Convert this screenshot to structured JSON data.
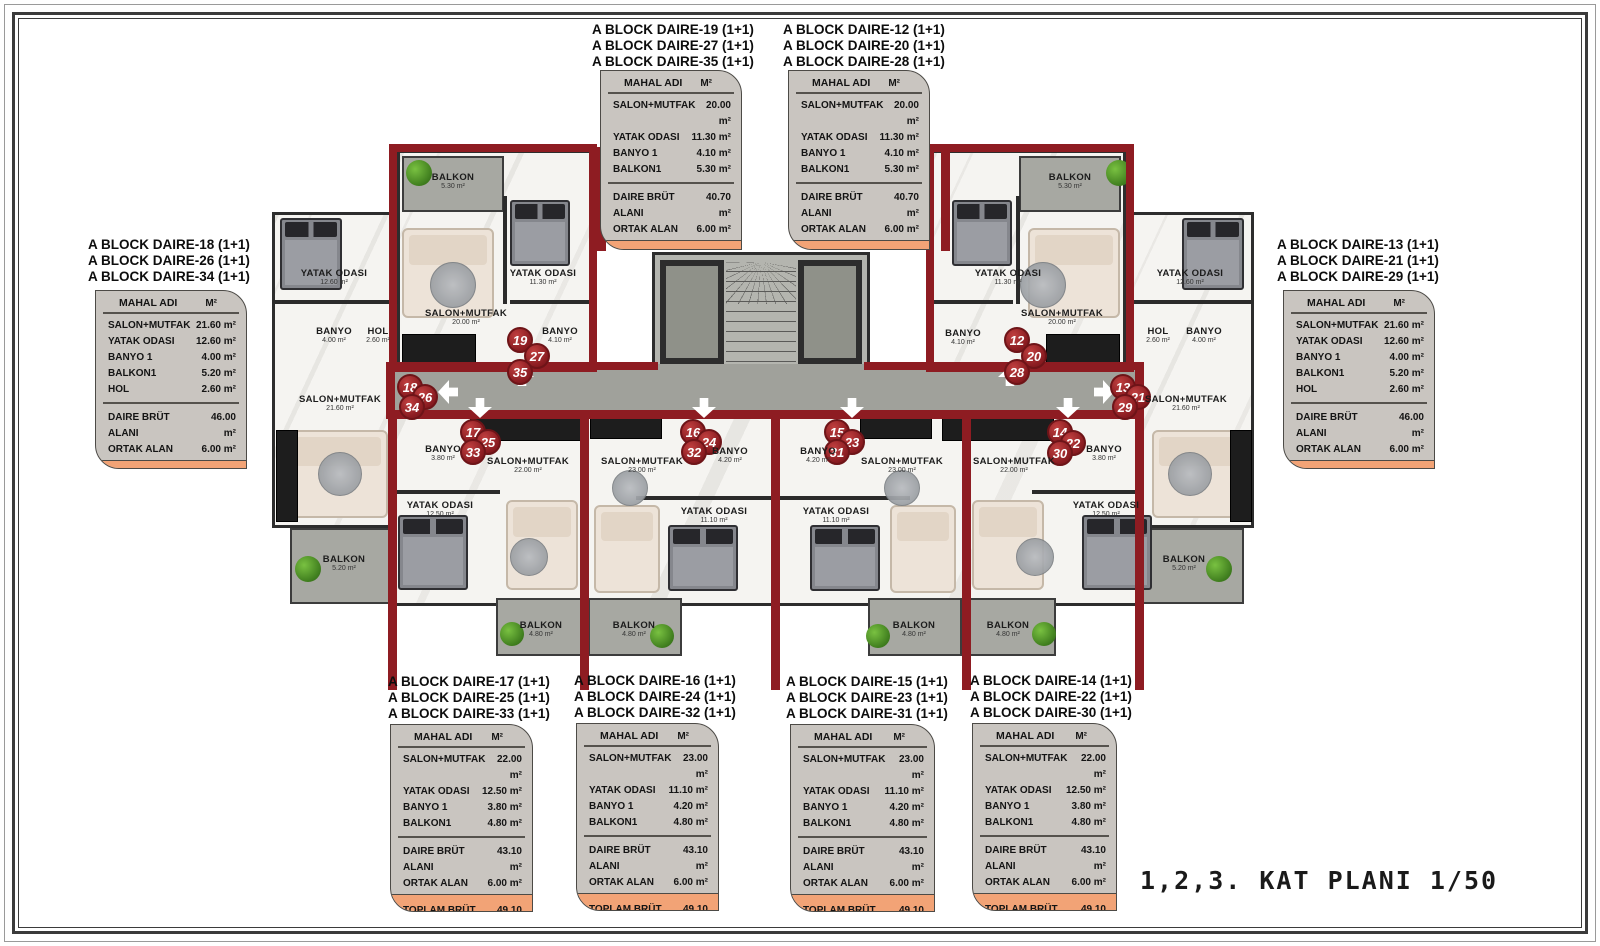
{
  "page": {
    "plan_title": "1,2,3. KAT PLANI 1/50"
  },
  "colors": {
    "unit_line_red": "#8e1c22",
    "badge_red": "#8c1d22",
    "card_gray": "#c9c5c0",
    "card_orange": "#f2a376",
    "wall_dark": "#2d2d2d"
  },
  "icons": {
    "entrance_arrow": "⇩ white outlined arrow",
    "plant": "green shrub circle"
  },
  "table_header": {
    "name_col": "MAHAL ADI",
    "unit_col": "M²"
  },
  "cards": [
    {
      "titles": [
        "A BLOCK DAIRE-18  (1+1)",
        "A BLOCK DAIRE-26  (1+1)",
        "A BLOCK DAIRE-34  (1+1)"
      ],
      "rows": [
        {
          "label": "SALON+MUTFAK",
          "value": "21.60 m²"
        },
        {
          "label": "YATAK ODASI",
          "value": "12.60 m²"
        },
        {
          "label": "BANYO 1",
          "value": "4.00 m²"
        },
        {
          "label": "BALKON1",
          "value": "5.20 m²"
        },
        {
          "label": "HOL",
          "value": "2.60 m²"
        }
      ],
      "totals": [
        {
          "label": "DAIRE BRÜT ALANI",
          "value": "46.00 m²"
        },
        {
          "label": "ORTAK ALAN",
          "value": "6.00 m²"
        }
      ],
      "footer": {
        "label": "TOPLAM BRÜT ALAN",
        "value": "52.00 m²"
      }
    },
    {
      "titles": [
        "A BLOCK DAIRE-19  (1+1)",
        "A BLOCK DAIRE-27  (1+1)",
        "A BLOCK DAIRE-35  (1+1)"
      ],
      "rows": [
        {
          "label": "SALON+MUTFAK",
          "value": "20.00 m²"
        },
        {
          "label": "YATAK ODASI",
          "value": "11.30 m²"
        },
        {
          "label": "BANYO 1",
          "value": "4.10 m²"
        },
        {
          "label": "BALKON1",
          "value": "5.30 m²"
        }
      ],
      "totals": [
        {
          "label": "DAIRE BRÜT ALANI",
          "value": "40.70 m²"
        },
        {
          "label": "ORTAK ALAN",
          "value": "6.00 m²"
        }
      ],
      "footer": {
        "label": "TOPLAM BRÜT ALAN",
        "value": "46.70 m²"
      }
    },
    {
      "titles": [
        "A BLOCK DAIRE-12  (1+1)",
        "A BLOCK DAIRE-20  (1+1)",
        "A BLOCK DAIRE-28  (1+1)"
      ],
      "rows": [
        {
          "label": "SALON+MUTFAK",
          "value": "20.00 m²"
        },
        {
          "label": "YATAK ODASI",
          "value": "11.30 m²"
        },
        {
          "label": "BANYO 1",
          "value": "4.10 m²"
        },
        {
          "label": "BALKON1",
          "value": "5.30 m²"
        }
      ],
      "totals": [
        {
          "label": "DAIRE BRÜT ALANI",
          "value": "40.70 m²"
        },
        {
          "label": "ORTAK ALAN",
          "value": "6.00 m²"
        }
      ],
      "footer": {
        "label": "TOPLAM BRÜT ALAN",
        "value": "46.70 m²"
      }
    },
    {
      "titles": [
        "A BLOCK DAIRE-13  (1+1)",
        "A BLOCK DAIRE-21  (1+1)",
        "A BLOCK DAIRE-29  (1+1)"
      ],
      "rows": [
        {
          "label": "SALON+MUTFAK",
          "value": "21.60 m²"
        },
        {
          "label": "YATAK ODASI",
          "value": "12.60 m²"
        },
        {
          "label": "BANYO 1",
          "value": "4.00 m²"
        },
        {
          "label": "BALKON1",
          "value": "5.20 m²"
        },
        {
          "label": "HOL",
          "value": "2.60 m²"
        }
      ],
      "totals": [
        {
          "label": "DAIRE BRÜT ALANI",
          "value": "46.00 m²"
        },
        {
          "label": "ORTAK ALAN",
          "value": "6.00 m²"
        }
      ],
      "footer": {
        "label": "TOPLAM BRÜT ALAN",
        "value": "52.00 m²"
      }
    },
    {
      "titles": [
        "A BLOCK DAIRE-17  (1+1)",
        "A BLOCK DAIRE-25  (1+1)",
        "A BLOCK DAIRE-33  (1+1)"
      ],
      "rows": [
        {
          "label": "SALON+MUTFAK",
          "value": "22.00 m²"
        },
        {
          "label": "YATAK ODASI",
          "value": "12.50 m²"
        },
        {
          "label": "BANYO 1",
          "value": "3.80 m²"
        },
        {
          "label": "BALKON1",
          "value": "4.80 m²"
        }
      ],
      "totals": [
        {
          "label": "DAIRE BRÜT ALANI",
          "value": "43.10 m²"
        },
        {
          "label": "ORTAK ALAN",
          "value": "6.00 m²"
        }
      ],
      "footer": {
        "label": "TOPLAM BRÜT ALAN",
        "value": "49.10 m²"
      }
    },
    {
      "titles": [
        "A BLOCK DAIRE-16  (1+1)",
        "A BLOCK DAIRE-24  (1+1)",
        "A BLOCK DAIRE-32  (1+1)"
      ],
      "rows": [
        {
          "label": "SALON+MUTFAK",
          "value": "23.00 m²"
        },
        {
          "label": "YATAK ODASI",
          "value": "11.10 m²"
        },
        {
          "label": "BANYO 1",
          "value": "4.20 m²"
        },
        {
          "label": "BALKON1",
          "value": "4.80 m²"
        }
      ],
      "totals": [
        {
          "label": "DAIRE BRÜT ALANI",
          "value": "43.10 m²"
        },
        {
          "label": "ORTAK ALAN",
          "value": "6.00 m²"
        }
      ],
      "footer": {
        "label": "TOPLAM BRÜT ALAN",
        "value": "49.10 m²"
      }
    },
    {
      "titles": [
        "A BLOCK DAIRE-15  (1+1)",
        "A BLOCK DAIRE-23  (1+1)",
        "A BLOCK DAIRE-31  (1+1)"
      ],
      "rows": [
        {
          "label": "SALON+MUTFAK",
          "value": "23.00 m²"
        },
        {
          "label": "YATAK ODASI",
          "value": "11.10 m²"
        },
        {
          "label": "BANYO 1",
          "value": "4.20 m²"
        },
        {
          "label": "BALKON1",
          "value": "4.80 m²"
        }
      ],
      "totals": [
        {
          "label": "DAIRE BRÜT ALANI",
          "value": "43.10 m²"
        },
        {
          "label": "ORTAK ALAN",
          "value": "6.00 m²"
        }
      ],
      "footer": {
        "label": "TOPLAM BRÜT ALAN",
        "value": "49.10 m²"
      }
    },
    {
      "titles": [
        "A BLOCK DAIRE-14  (1+1)",
        "A BLOCK DAIRE-22  (1+1)",
        "A BLOCK DAIRE-30  (1+1)"
      ],
      "rows": [
        {
          "label": "SALON+MUTFAK",
          "value": "22.00 m²"
        },
        {
          "label": "YATAK ODASI",
          "value": "12.50 m²"
        },
        {
          "label": "BANYO 1",
          "value": "3.80 m²"
        },
        {
          "label": "BALKON1",
          "value": "4.80 m²"
        }
      ],
      "totals": [
        {
          "label": "DAIRE BRÜT ALANI",
          "value": "43.10 m²"
        },
        {
          "label": "ORTAK ALAN",
          "value": "6.00 m²"
        }
      ],
      "footer": {
        "label": "TOPLAM BRÜT ALAN",
        "value": "49.10 m²"
      }
    }
  ],
  "plan": {
    "units": [
      {
        "key": "19-27-35",
        "badges": [
          "19",
          "27",
          "35"
        ],
        "rooms": [
          {
            "name": "BALKON",
            "area": "5.30 m²"
          },
          {
            "name": "SALON+MUTFAK",
            "area": "20.00 m²"
          },
          {
            "name": "YATAK ODASI",
            "area": "11.30 m²"
          },
          {
            "name": "BANYO",
            "area": "4.10 m²"
          }
        ]
      },
      {
        "key": "12-20-28",
        "badges": [
          "12",
          "20",
          "28"
        ],
        "rooms": [
          {
            "name": "BALKON",
            "area": "5.30 m²"
          },
          {
            "name": "YATAK ODASI",
            "area": "11.30 m²"
          },
          {
            "name": "SALON+MUTFAK",
            "area": "20.00 m²"
          },
          {
            "name": "BANYO",
            "area": "4.10 m²"
          }
        ]
      },
      {
        "key": "18-26-34",
        "badges": [
          "18",
          "26",
          "34"
        ],
        "rooms": [
          {
            "name": "YATAK ODASI",
            "area": "12.60 m²"
          },
          {
            "name": "BANYO",
            "area": "4.00 m²"
          },
          {
            "name": "HOL",
            "area": "2.60 m²"
          },
          {
            "name": "SALON+MUTFAK",
            "area": "21.60 m²"
          },
          {
            "name": "BALKON",
            "area": "5.20 m²"
          }
        ]
      },
      {
        "key": "13-21-29",
        "badges": [
          "13",
          "21",
          "29"
        ],
        "rooms": [
          {
            "name": "YATAK ODASI",
            "area": "12.60 m²"
          },
          {
            "name": "HOL",
            "area": "2.60 m²"
          },
          {
            "name": "BANYO",
            "area": "4.00 m²"
          },
          {
            "name": "SALON+MUTFAK",
            "area": "21.60 m²"
          },
          {
            "name": "BALKON",
            "area": "5.20 m²"
          }
        ]
      },
      {
        "key": "17-25-33",
        "badges": [
          "17",
          "25",
          "33"
        ],
        "rooms": [
          {
            "name": "BANYO",
            "area": "3.80 m²"
          },
          {
            "name": "SALON+MUTFAK",
            "area": "22.00 m²"
          },
          {
            "name": "YATAK ODASI",
            "area": "12.50 m²"
          },
          {
            "name": "BALKON",
            "area": "4.80 m²"
          }
        ]
      },
      {
        "key": "16-24-32",
        "badges": [
          "16",
          "24",
          "32"
        ],
        "rooms": [
          {
            "name": "SALON+MUTFAK",
            "area": "23.00 m²"
          },
          {
            "name": "BANYO",
            "area": "4.20 m²"
          },
          {
            "name": "YATAK ODASI",
            "area": "11.10 m²"
          },
          {
            "name": "BALKON",
            "area": "4.80 m²"
          }
        ]
      },
      {
        "key": "15-23-31",
        "badges": [
          "15",
          "23",
          "31"
        ],
        "rooms": [
          {
            "name": "BANYO",
            "area": "4.20 m²"
          },
          {
            "name": "SALON+MUTFAK",
            "area": "23.00 m²"
          },
          {
            "name": "YATAK ODASI",
            "area": "11.10 m²"
          },
          {
            "name": "BALKON",
            "area": "4.80 m²"
          }
        ]
      },
      {
        "key": "14-22-30",
        "badges": [
          "14",
          "22",
          "30"
        ],
        "rooms": [
          {
            "name": "BANYO",
            "area": "3.80 m²"
          },
          {
            "name": "SALON+MUTFAK",
            "area": "22.00 m²"
          },
          {
            "name": "YATAK ODASI",
            "area": "12.50 m²"
          },
          {
            "name": "BALKON",
            "area": "4.80 m²"
          }
        ]
      }
    ]
  }
}
